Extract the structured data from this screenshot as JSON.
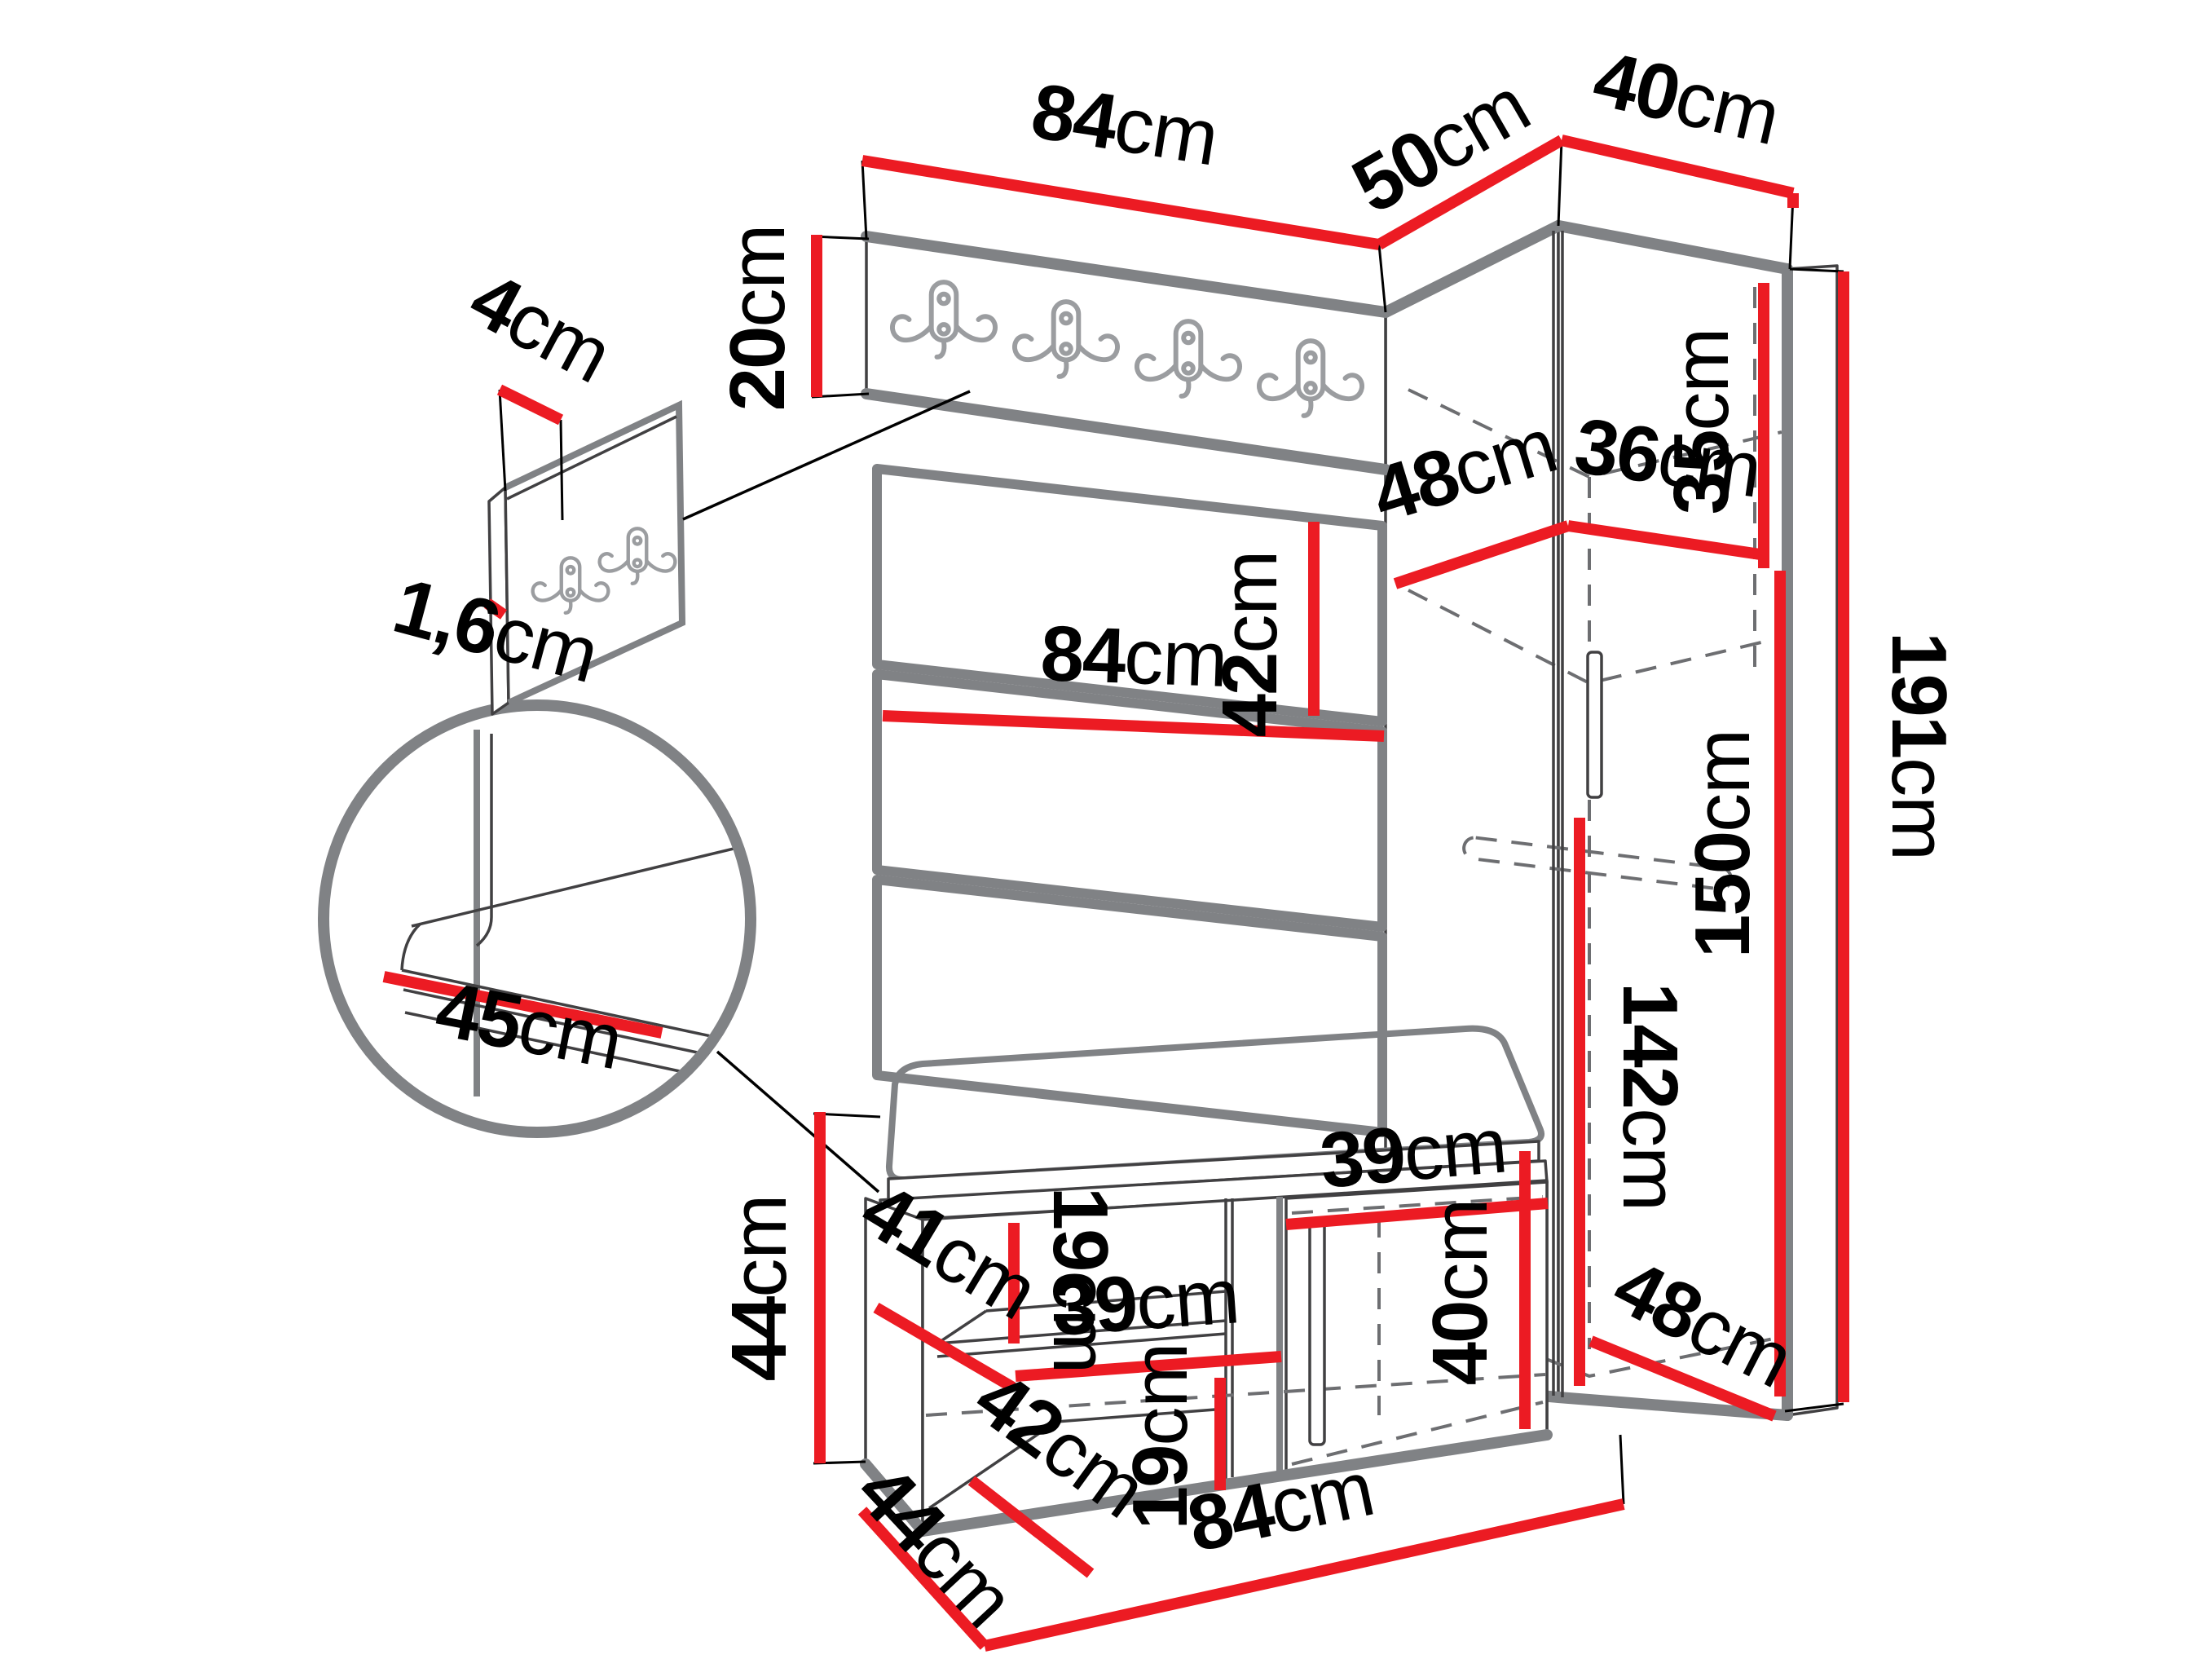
{
  "figure": {
    "kind": "furniture dimension diagram",
    "description": "Hallway set: coat-hook panel with upholstered wall panels, corner wardrobe and shoe bench with cushion, annotated with centimetre dimensions"
  },
  "unit": "cm",
  "colors": {
    "dimension_line": "#ec1b23",
    "shadow_edge": "#808285",
    "outline": "#414042",
    "background": "#ffffff",
    "text": "#000000"
  },
  "dimensions": {
    "hook_board_width": "84",
    "wardrobe_left_width": "50",
    "wardrobe_right_width": "40",
    "hook_board_height": "20",
    "hook_strip_width": "4",
    "hook_strip_thickness": "1,6",
    "panel_height": "42",
    "top_shelf_depth": "48",
    "top_shelf_width": "36",
    "top_compartment_height": "35",
    "panel_width": "84",
    "wardrobe_height": "191",
    "hanging_space_height": "150",
    "door_height": "142",
    "seat_depth": "45",
    "bench_height": "44",
    "bench_shelf_depth": "41",
    "bench_upper_gap": "19",
    "bench_shelf_width": "39",
    "bench_lower_depth": "42",
    "bench_lower_gap": "19",
    "bench_door_width": "39",
    "bench_door_height": "40",
    "wardrobe_bottom_depth": "48",
    "bench_width": "84",
    "bench_depth": "44"
  }
}
